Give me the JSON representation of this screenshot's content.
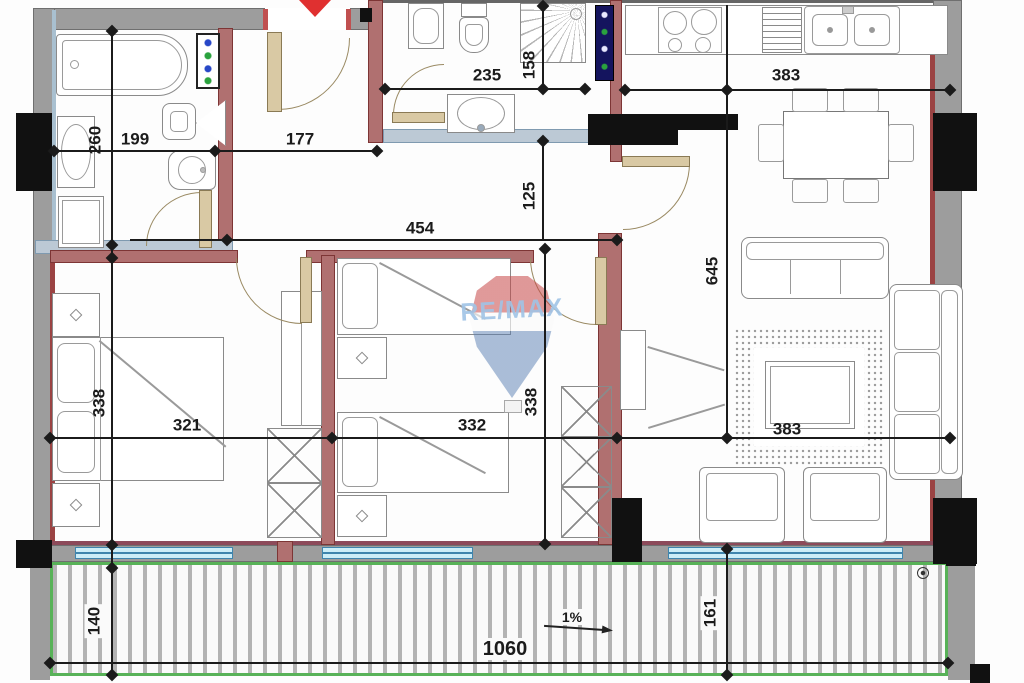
{
  "watermark": {
    "brand": "RE/MAX"
  },
  "annotations": {
    "slope": "1%"
  },
  "dimensions": {
    "bathroom_height": "260",
    "bathroom_width": "199",
    "hall_width": "177",
    "bathroom2_width": "235",
    "shower_depth": "158",
    "kitchen_width": "383",
    "corridor_height": "125",
    "corridor_width": "454",
    "living_height": "645",
    "bedroom1_height": "338",
    "bedroom1_width": "321",
    "bedroom2_width": "332",
    "bedroom2_height": "338",
    "living_width": "383",
    "terrace_depth_left": "140",
    "terrace_length": "1060",
    "terrace_depth_right": "161"
  },
  "colors": {
    "wall_fill": "#9d9d9d",
    "interior_wall": "#b07070",
    "bathroom_wall": "#bcc9d5",
    "window": "#cdeef8",
    "terrace_border": "#58b258",
    "door": "#d9c9a4",
    "entrance_marker": "#e03030",
    "dimension": "#1b1b1b",
    "watermark_text": "#9fc3e4"
  }
}
